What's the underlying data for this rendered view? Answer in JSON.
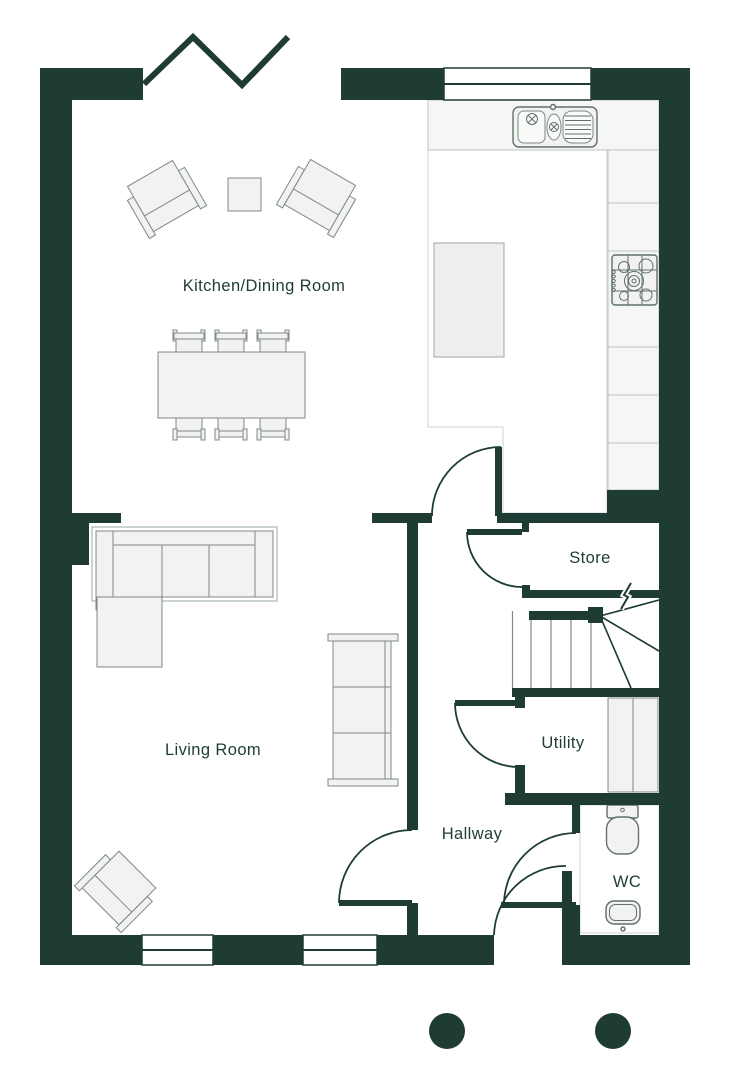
{
  "page": {
    "type": "floor-plan",
    "level": "ground-floor"
  },
  "rooms": {
    "kitchen_dining": {
      "label": "Kitchen/Dining Room"
    },
    "living": {
      "label": "Living Room"
    },
    "hallway": {
      "label": "Hallway"
    },
    "store": {
      "label": "Store"
    },
    "utility": {
      "label": "Utility"
    },
    "wc": {
      "label": "WC"
    }
  },
  "features": {
    "doors": [
      "kitchen-door",
      "store-door",
      "utility-door",
      "living-room-door",
      "wc-door",
      "front-door"
    ],
    "windows": [
      "top-window",
      "bottom-window-1",
      "bottom-window-2"
    ],
    "opening": "bifold-opening-symbol",
    "stairs": "quarter-winder-staircase",
    "legend_dots": 2
  },
  "colors": {
    "wall": "#1e3c33",
    "text": "#1e3c33",
    "furniture_outline": "#7c8b84",
    "furniture_fill": "#f2f2f1",
    "fixture_outline": "#5f7168",
    "tile_grout": "#d8d8e0",
    "counter_fill": "#f6f6f4",
    "floor": "#ffffff"
  }
}
